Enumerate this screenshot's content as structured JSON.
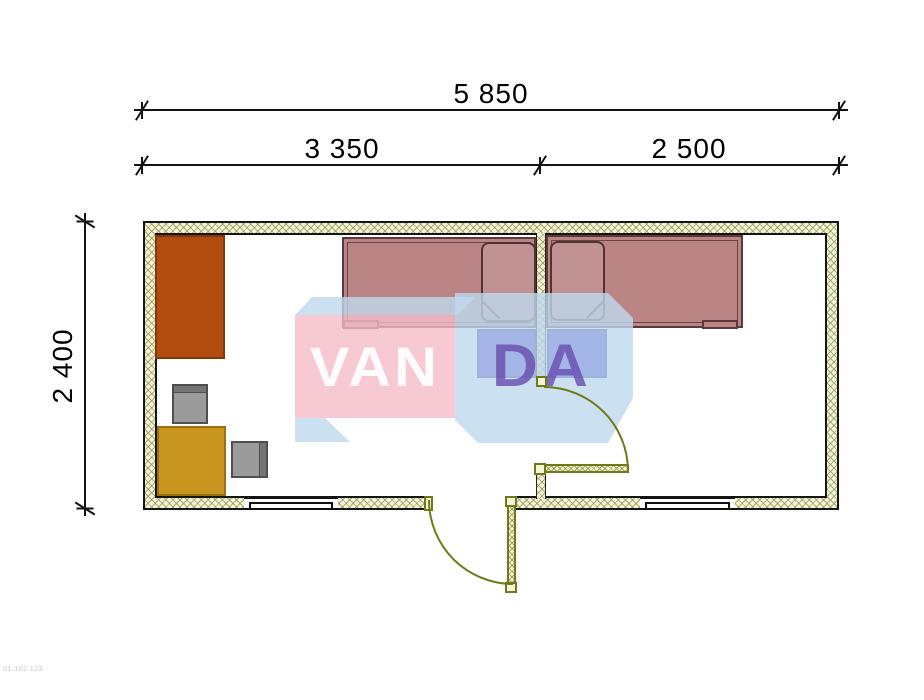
{
  "dimensions": {
    "total_width": "5 850",
    "left_section": "3 350",
    "right_section": "2 500",
    "height": "2 400",
    "unit": "mm"
  },
  "watermark": {
    "front_text": "VAN",
    "side_text": "DA"
  },
  "corner_code": "01.102.123",
  "plan": {
    "type": "floor-plan",
    "rooms": [
      {
        "name": "left-room",
        "width_label": "3 350",
        "furniture": [
          "wardrobe",
          "single-bed",
          "pillow",
          "nightstand",
          "desk-chair",
          "table",
          "side-chair"
        ],
        "openings": [
          "window",
          "entrance-door"
        ]
      },
      {
        "name": "right-room",
        "width_label": "2 500",
        "furniture": [
          "single-bed",
          "pillow",
          "nightstand"
        ],
        "openings": [
          "window",
          "interior-door"
        ]
      }
    ]
  },
  "colors": {
    "wall_fill": "#f4f3dc",
    "wall_hatch": "#949446",
    "outline": "#151515",
    "bed_fill": "#bb8586",
    "bed_outline": "#5d3a3a",
    "pillow_fill": "#c19293",
    "nightstand_fill": "#3d31c6",
    "wardrobe_fill": "#b24b10",
    "table_fill": "#c8951e",
    "chair_fill": "#9b9b9b",
    "door_line": "#6f7a17",
    "wm_pink": "rgba(244,188,200,0.8)",
    "wm_blue": "rgba(190,216,238,0.8)",
    "wm_purple": "rgba(104,78,176,0.82)"
  }
}
